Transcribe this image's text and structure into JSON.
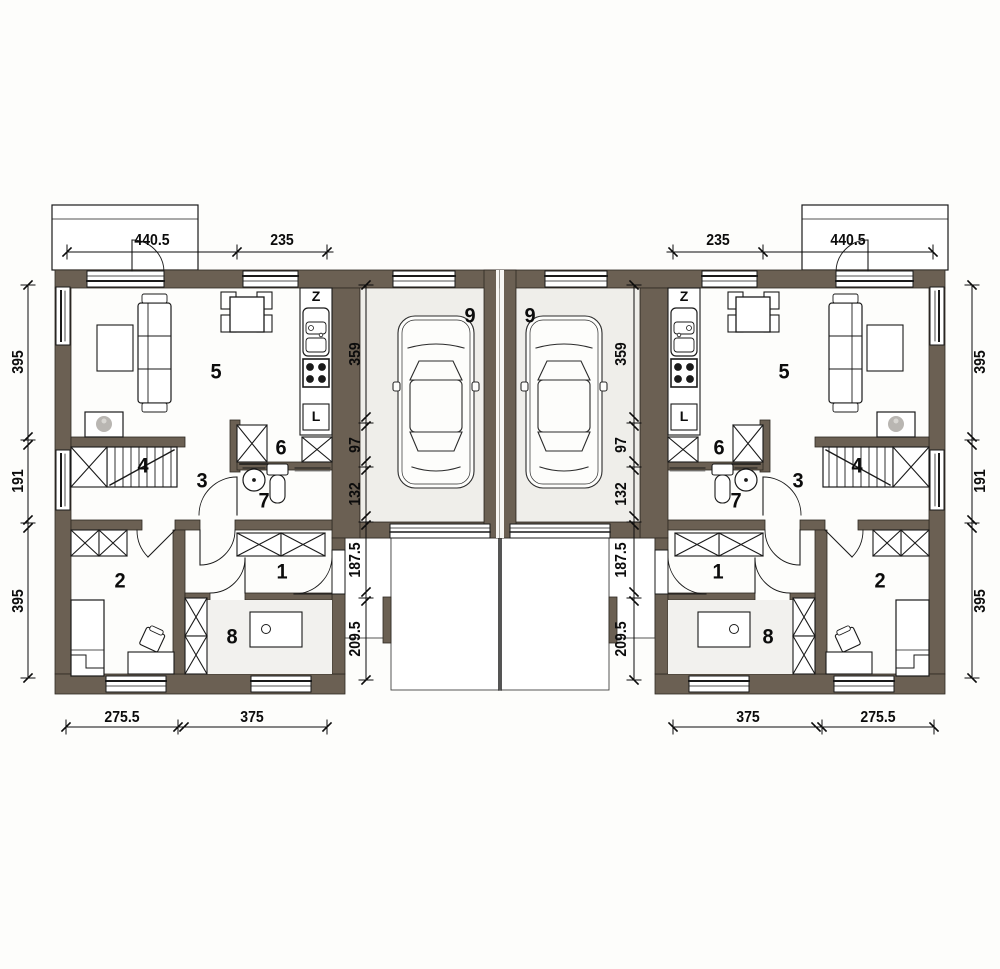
{
  "plan": {
    "title": "semi-detached house ground floor plan",
    "room_labels": {
      "entry_hall": "1",
      "bedroom": "2",
      "hall": "3",
      "stairs": "4",
      "living_room": "5",
      "closet": "6",
      "bathroom": "7",
      "utility_room": "8",
      "garage": "9"
    },
    "kitchen_labels": {
      "sink": "Z",
      "fridge": "L"
    },
    "dimensions": {
      "top": [
        "440.5",
        "235"
      ],
      "side": [
        "395",
        "191",
        "395"
      ],
      "bottom": [
        "275.5",
        "375"
      ],
      "garage": [
        "359",
        "97",
        "132"
      ],
      "driveway": [
        "187.5",
        "209.5"
      ]
    },
    "colors": {
      "wall": "#6b6053",
      "line": "#1a1a1a",
      "garage_floor": "#efeeea",
      "utility_floor": "#f2f1ee",
      "fireplace_gray": "#b9b6b2"
    }
  }
}
